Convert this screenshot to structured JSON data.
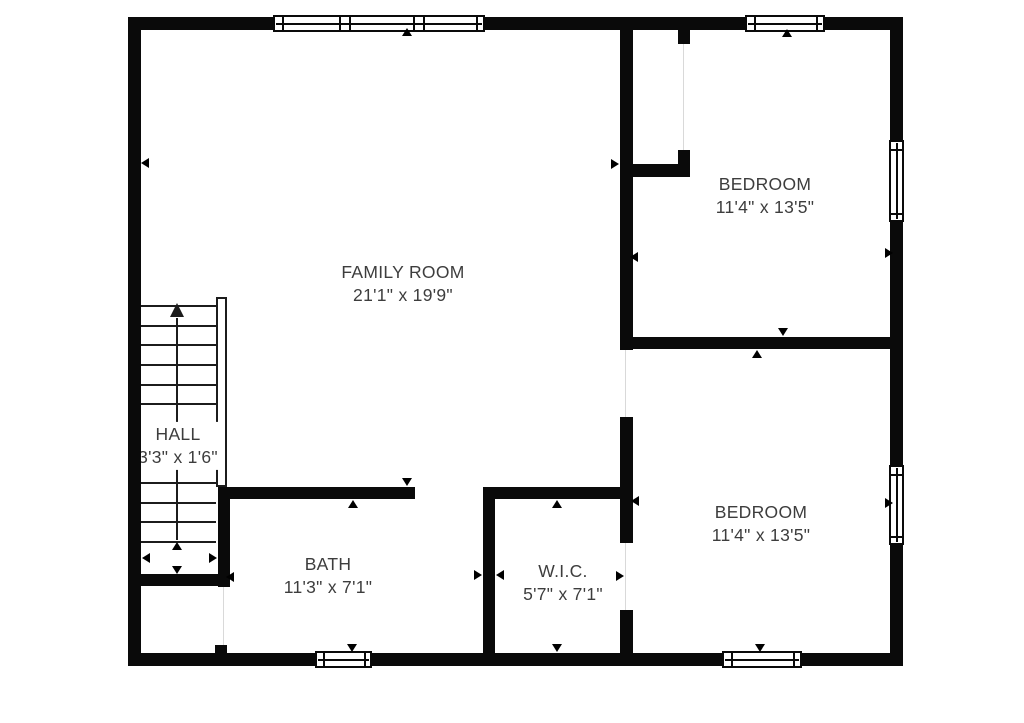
{
  "colors": {
    "wall": "#0a0a0a",
    "text": "#3d3d3d",
    "bg": "#ffffff"
  },
  "plan": {
    "canvas": {
      "w": 1024,
      "h": 723
    },
    "rooms": [
      {
        "name": "FAMILY ROOM",
        "dims": "21'1\" x 19'9\"",
        "cx": 403,
        "cy": 284
      },
      {
        "name": "BEDROOM",
        "dims": "11'4\" x 13'5\"",
        "cx": 765,
        "cy": 196
      },
      {
        "name": "BEDROOM",
        "dims": "11'4\" x 13'5\"",
        "cx": 761,
        "cy": 524
      },
      {
        "name": "HALL",
        "dims": "3'3\" x 1'6\"",
        "cx": 178,
        "cy": 446
      },
      {
        "name": "BATH",
        "dims": "11'3\" x 7'1\"",
        "cx": 328,
        "cy": 576
      },
      {
        "name": "W.I.C.",
        "dims": "5'7\" x 7'1\"",
        "cx": 563,
        "cy": 583
      }
    ],
    "walls": [
      {
        "x": 128,
        "y": 17,
        "w": 775,
        "h": 13
      },
      {
        "x": 128,
        "y": 653,
        "w": 775,
        "h": 13
      },
      {
        "x": 128,
        "y": 17,
        "w": 13,
        "h": 649
      },
      {
        "x": 890,
        "y": 17,
        "w": 13,
        "h": 649
      },
      {
        "x": 620,
        "y": 30,
        "w": 13,
        "h": 320
      },
      {
        "x": 620,
        "y": 417,
        "w": 13,
        "h": 126
      },
      {
        "x": 620,
        "y": 610,
        "w": 13,
        "h": 43
      },
      {
        "x": 678,
        "y": 30,
        "w": 12,
        "h": 14
      },
      {
        "x": 633,
        "y": 164,
        "w": 57,
        "h": 13
      },
      {
        "x": 678,
        "y": 150,
        "w": 12,
        "h": 14
      },
      {
        "x": 633,
        "y": 337,
        "w": 257,
        "h": 12
      },
      {
        "x": 218,
        "y": 487,
        "w": 197,
        "h": 12
      },
      {
        "x": 483,
        "y": 487,
        "w": 150,
        "h": 12
      },
      {
        "x": 218,
        "y": 499,
        "w": 12,
        "h": 88
      },
      {
        "x": 128,
        "y": 574,
        "w": 97,
        "h": 12
      },
      {
        "x": 483,
        "y": 499,
        "w": 12,
        "h": 154
      },
      {
        "x": 215,
        "y": 645,
        "w": 12,
        "h": 8
      }
    ],
    "door_openings": [
      {
        "x": 683,
        "y1": 44,
        "y2": 150
      },
      {
        "x": 625,
        "y1": 350,
        "y2": 417
      },
      {
        "x": 625,
        "y1": 543,
        "y2": 610
      },
      {
        "x": 223,
        "y1": 587,
        "y2": 645
      }
    ],
    "windows": [
      {
        "x": 273,
        "y": 15,
        "w": 212,
        "h": 17,
        "orient": "h",
        "caps": [
          9,
          66,
          76,
          140,
          150,
          203
        ]
      },
      {
        "x": 745,
        "y": 15,
        "w": 80,
        "h": 17,
        "orient": "h",
        "caps": [
          9,
          71
        ]
      },
      {
        "x": 889,
        "y": 140,
        "w": 15,
        "h": 82,
        "orient": "v",
        "caps": [
          9,
          73
        ]
      },
      {
        "x": 889,
        "y": 465,
        "w": 15,
        "h": 80,
        "orient": "v",
        "caps": [
          9,
          71
        ]
      },
      {
        "x": 315,
        "y": 651,
        "w": 57,
        "h": 17,
        "orient": "h",
        "caps": [
          8,
          49
        ]
      },
      {
        "x": 722,
        "y": 651,
        "w": 80,
        "h": 17,
        "orient": "h",
        "caps": [
          9,
          71
        ]
      }
    ],
    "stairs": {
      "x": 141,
      "top": 305,
      "width": 75,
      "tread_count": 13,
      "tread_step": 19.66,
      "rail": {
        "x": 216,
        "y": 297,
        "w": 11,
        "h": 190
      },
      "arrow": {
        "x": 177,
        "head_y": 303,
        "shaft_top": 318,
        "shaft_bottom": 540
      }
    },
    "markers": [
      {
        "x": 407,
        "y": 28,
        "d": "up"
      },
      {
        "x": 787,
        "y": 29,
        "d": "up"
      },
      {
        "x": 141,
        "y": 163,
        "d": "left"
      },
      {
        "x": 619,
        "y": 164,
        "d": "right"
      },
      {
        "x": 630,
        "y": 257,
        "d": "left"
      },
      {
        "x": 893,
        "y": 253,
        "d": "right"
      },
      {
        "x": 783,
        "y": 336,
        "d": "down"
      },
      {
        "x": 757,
        "y": 350,
        "d": "up"
      },
      {
        "x": 893,
        "y": 503,
        "d": "right"
      },
      {
        "x": 631,
        "y": 501,
        "d": "left"
      },
      {
        "x": 407,
        "y": 486,
        "d": "down"
      },
      {
        "x": 353,
        "y": 500,
        "d": "up"
      },
      {
        "x": 352,
        "y": 652,
        "d": "down"
      },
      {
        "x": 760,
        "y": 652,
        "d": "down"
      },
      {
        "x": 482,
        "y": 575,
        "d": "right"
      },
      {
        "x": 496,
        "y": 575,
        "d": "left"
      },
      {
        "x": 624,
        "y": 576,
        "d": "right"
      },
      {
        "x": 557,
        "y": 500,
        "d": "up"
      },
      {
        "x": 557,
        "y": 652,
        "d": "down"
      },
      {
        "x": 177,
        "y": 542,
        "d": "up"
      },
      {
        "x": 177,
        "y": 574,
        "d": "down"
      },
      {
        "x": 142,
        "y": 558,
        "d": "left"
      },
      {
        "x": 217,
        "y": 558,
        "d": "right"
      },
      {
        "x": 226,
        "y": 577,
        "d": "left"
      }
    ]
  }
}
